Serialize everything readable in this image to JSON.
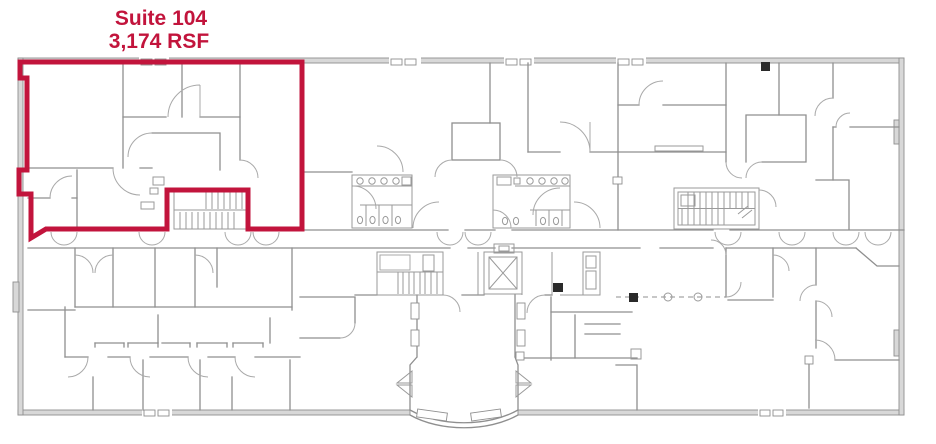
{
  "overlay": {
    "suite_name": "Suite 104",
    "suite_area": "3,174 RSF",
    "highlight_color": "#c2143c"
  },
  "plan": {
    "wall_color": "#8f8f8f",
    "wall_fill_color": "#d8d8d8",
    "elements": [
      "suite-104-outline",
      "restroom-left",
      "restroom-right",
      "stairwell-suite",
      "stairwell-east",
      "stairwell-lobby",
      "elevator-shaft",
      "entrance-vestibule",
      "demolition-line"
    ]
  }
}
